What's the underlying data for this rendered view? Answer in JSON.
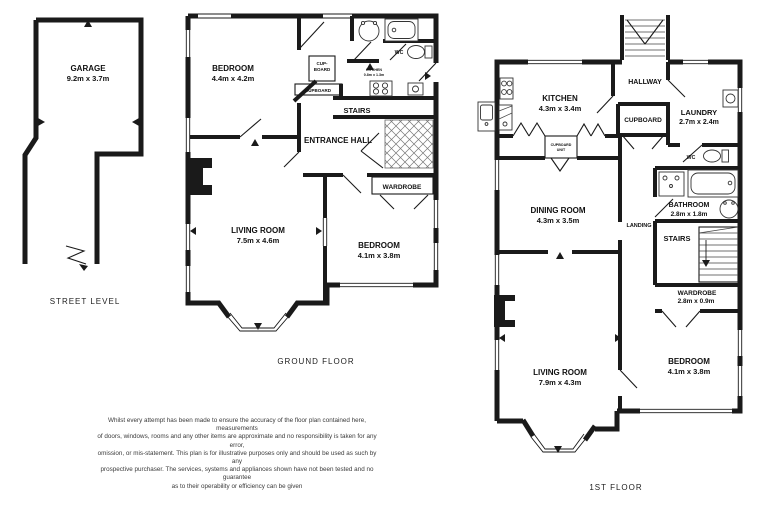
{
  "street_level": {
    "garage": {
      "name": "GARAGE",
      "dims": "9.2m x 3.7m"
    },
    "caption": "STREET LEVEL"
  },
  "ground_floor": {
    "caption": "GROUND FLOOR",
    "bedroom1": {
      "name": "BEDROOM",
      "dims": "4.4m x 4.2m"
    },
    "cupboard_small": {
      "line1": "CUP-",
      "line2": "BOARD"
    },
    "cupboard": {
      "name": "CUPBOARD"
    },
    "kitchenette": {
      "name": "KITCHEN",
      "dims": "0.8m x 1.3m"
    },
    "wc": {
      "name": "WC"
    },
    "stairs": {
      "name": "STAIRS"
    },
    "entrance_hall": {
      "name": "ENTRANCE HALL"
    },
    "wardrobe": {
      "name": "WARDROBE"
    },
    "living_room": {
      "name": "LIVING ROOM",
      "dims": "7.5m x 4.6m"
    },
    "bedroom2": {
      "name": "BEDROOM",
      "dims": "4.1m x 3.8m"
    }
  },
  "first_floor": {
    "caption": "1ST FLOOR",
    "kitchen": {
      "name": "KITCHEN",
      "dims": "4.3m x 3.4m"
    },
    "hallway": {
      "name": "HALLWAY"
    },
    "laundry": {
      "name": "LAUNDRY",
      "dims": "2.7m x 2.4m"
    },
    "cupboard": {
      "name": "CUPBOARD"
    },
    "cupboard_unit": {
      "line1": "CUPBOARD",
      "line2": "UNIT"
    },
    "wc": {
      "name": "WC"
    },
    "dining_room": {
      "name": "DINING ROOM",
      "dims": "4.3m x 3.5m"
    },
    "landing": {
      "name": "LANDING"
    },
    "bathroom": {
      "name": "BATHROOM",
      "dims": "2.8m x 1.8m"
    },
    "stairs": {
      "name": "STAIRS"
    },
    "wardrobe": {
      "name": "WARDROBE",
      "dims": "2.8m x 0.9m"
    },
    "living_room": {
      "name": "LIVING ROOM",
      "dims": "7.9m x 4.3m"
    },
    "bedroom": {
      "name": "BEDROOM",
      "dims": "4.1m x 3.8m"
    }
  },
  "disclaimer": {
    "lines": [
      "Whilst every attempt has been made to ensure the accuracy of the floor plan contained here, measurements",
      "of doors, windows, rooms and any other items are approximate and no responsibility is taken for any error,",
      "omission, or mis-statement. This plan is for illustrative purposes only and should be used as such by any",
      "prospective purchaser. The services, systems and appliances shown have not been tested and no guarantee",
      "as to their operability or efficiency can be given"
    ]
  }
}
